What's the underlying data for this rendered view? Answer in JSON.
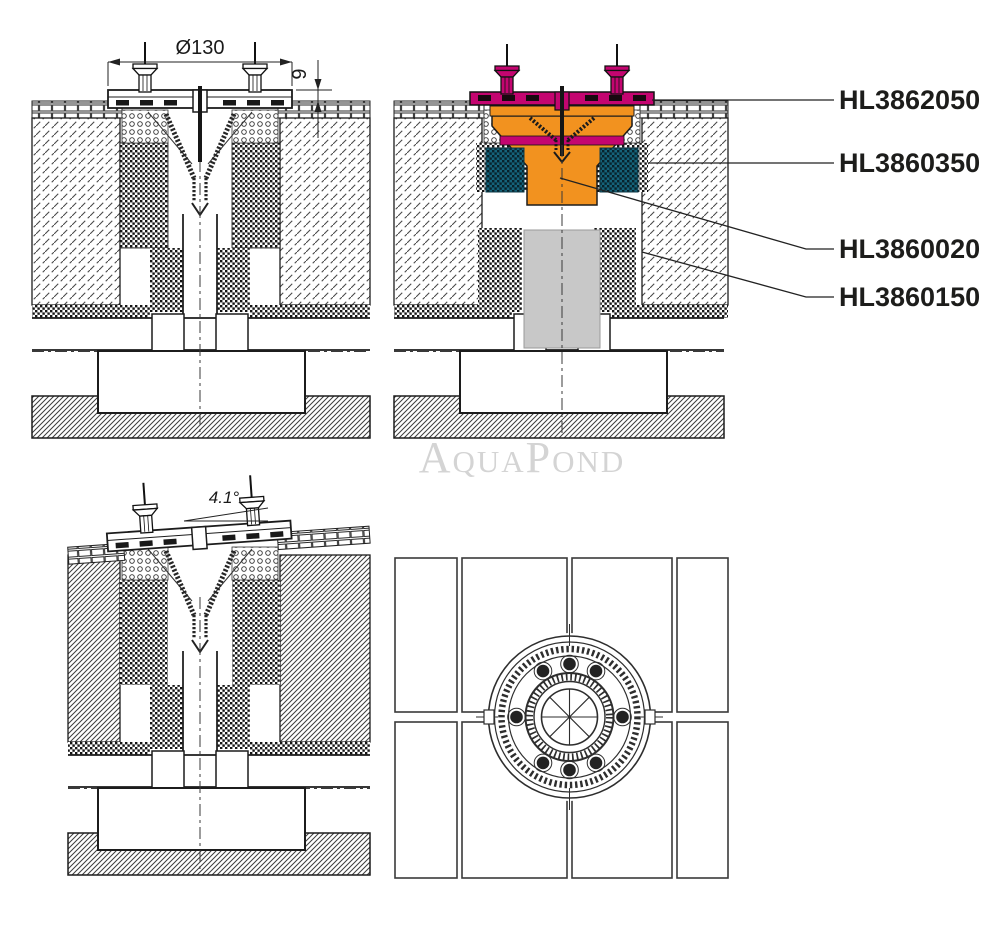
{
  "watermark": "AquaPond",
  "dimensions": {
    "diameter": "Ø130",
    "flange_height": "9",
    "slope_angle": "4.1°"
  },
  "part_labels": [
    {
      "code": "HL3862050",
      "color": "#c40570"
    },
    {
      "code": "HL3860350",
      "color": "#15637a"
    },
    {
      "code": "HL3860020",
      "color": "#f2921f"
    },
    {
      "code": "HL3860150",
      "color": "#c8c8c8"
    }
  ],
  "colors": {
    "magenta": "#c40570",
    "orange": "#f2921f",
    "teal": "#15637a",
    "pipe_gray": "#c8c8c8",
    "line": "#1c1c1c",
    "watermark_gray": "#d4d4d4"
  }
}
